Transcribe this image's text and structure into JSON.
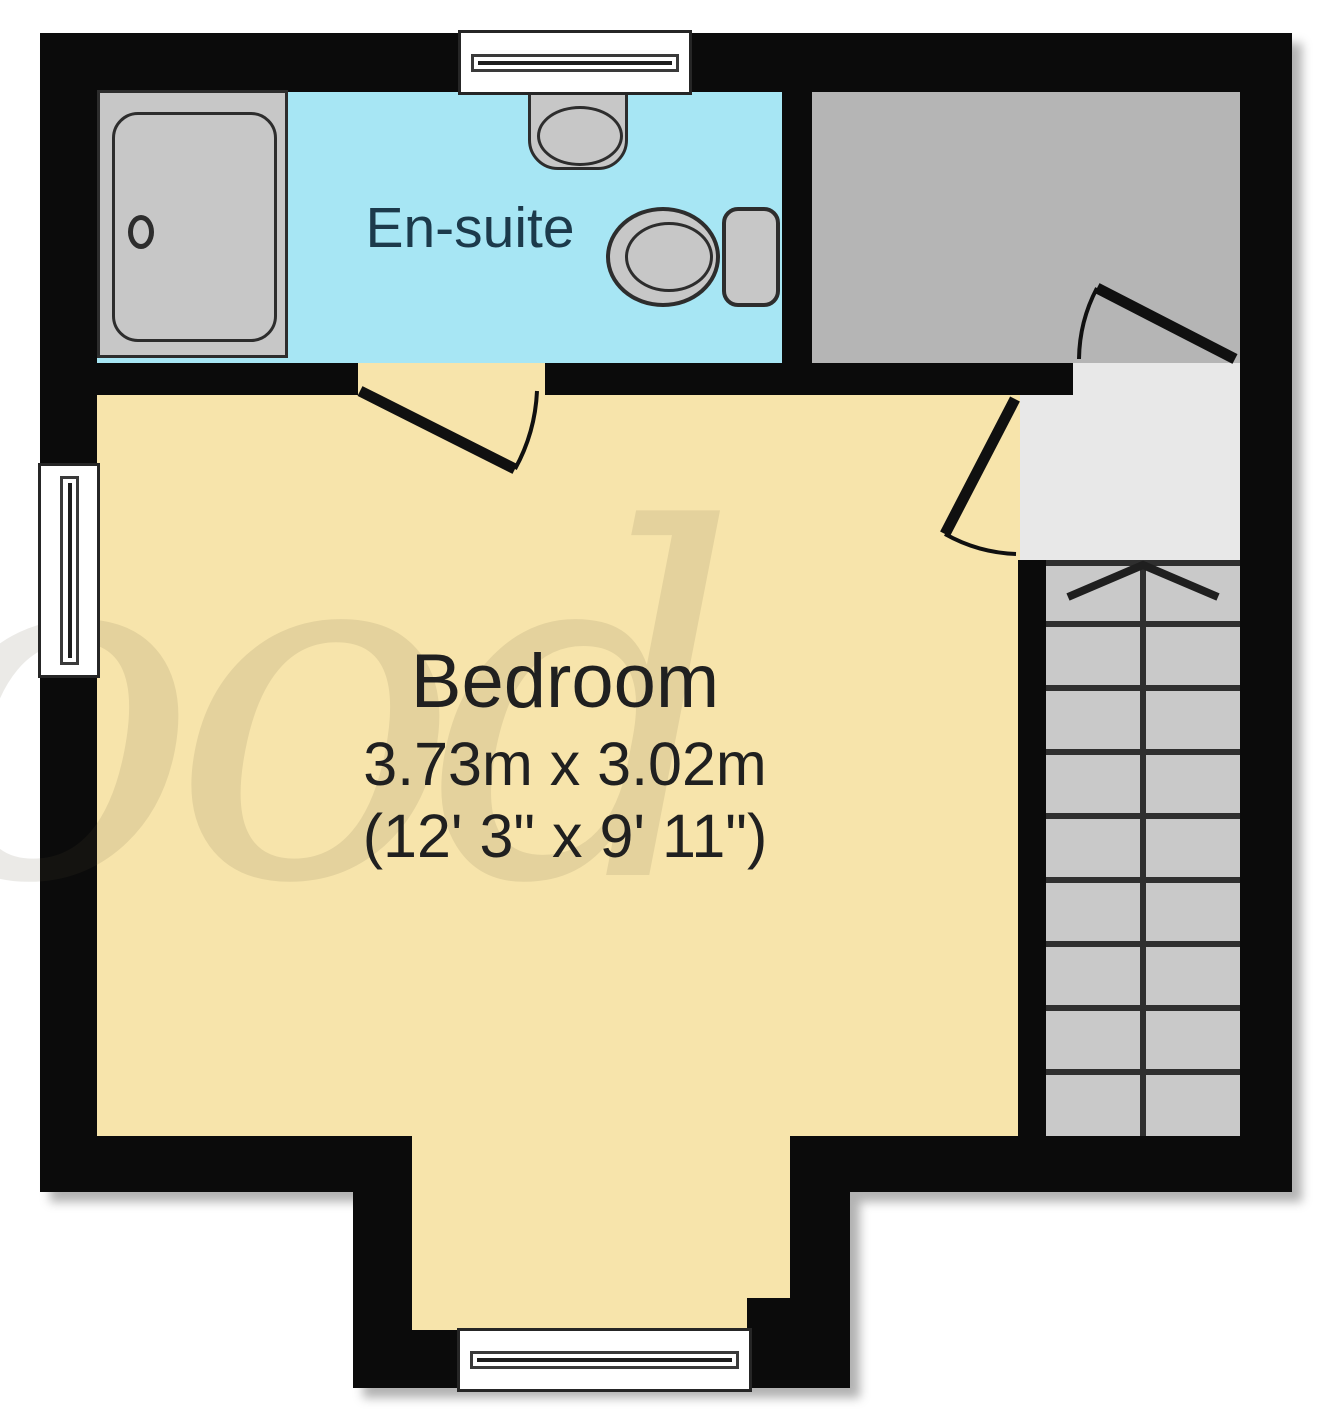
{
  "rooms": {
    "ensuite": {
      "label": "En-suite",
      "floor_color": "#a7e6f4"
    },
    "bedroom": {
      "label": "Bedroom",
      "size_metric": "3.73m x 3.02m",
      "size_imperial": "(12' 3\" x 9' 11\")",
      "floor_color": "#f7e4ab"
    },
    "store": {
      "floor_color": "#b5b5b5"
    },
    "landing": {
      "floor_color": "#e8e8e8"
    }
  },
  "stairs": {
    "direction_symbol": "up-arrow",
    "visible_treads": 9,
    "tread_color": "#c9c9c9"
  },
  "fixtures": [
    "shower-tray",
    "wash-basin",
    "toilet"
  ],
  "door_count": 3,
  "window_count": 3,
  "watermark": {
    "text": "ood"
  },
  "colors": {
    "wall": "#0b0b0b",
    "ensuite_text": "#1c3a4b",
    "bedroom_text": "#202020",
    "fixture_fill": "#c7c7c7",
    "background": "#ffffff"
  }
}
